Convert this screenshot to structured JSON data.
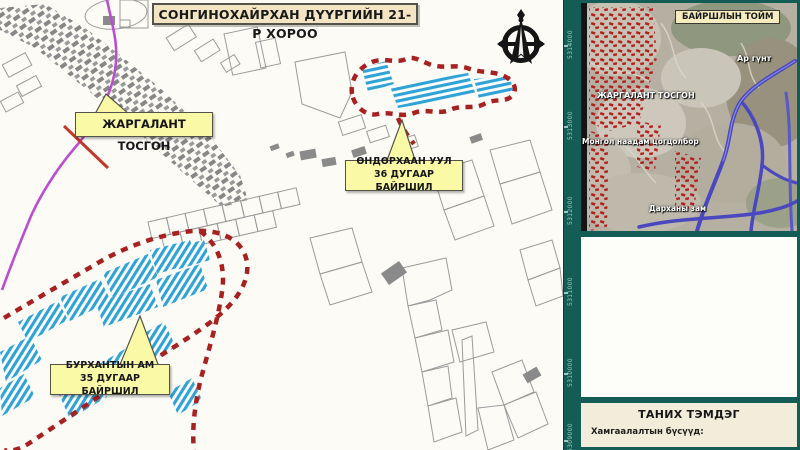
{
  "map": {
    "title": "СОНГИНОХАЙРХАН ДҮҮРГИЙН 21-Р ХОРОО",
    "callouts": {
      "jargalant": {
        "label": "ЖАРГАЛАНТ ТОСГОН"
      },
      "undurkhaan": {
        "line1": "ӨНДӨРХААН УУЛ",
        "line2": "36 ДУГААР БАЙРШИЛ"
      },
      "burkhantyn": {
        "line1": "БУРХАНТЫН АМ",
        "line2": "35 ДУГААР БАЙРШИЛ"
      }
    },
    "grid_labels": [
      "5314000",
      "5313000",
      "5312000",
      "5311000",
      "5310000",
      "5309000"
    ]
  },
  "inset": {
    "title": "БАЙРШЛЫН ТОЙМ",
    "labels": {
      "argunt": "Ар гүнт",
      "jargalant": "ЖАРГАЛАНТ ТОСГОН",
      "naadam": "Монгол наадам цогцолбор",
      "darkhan": "Дарханы зам"
    }
  },
  "legend": {
    "title": "ТАНИХ ТЭМДЭГ",
    "subtitle": "Хамгаалалтын бүсүүд:"
  },
  "colors": {
    "frame_teal": "#145d57",
    "title_bg": "#f3e5c3",
    "callout_yellow": "#fafaa6",
    "boundary_red": "#a82020",
    "parcel_hatch_blue": "#2fa3d6",
    "road_purple": "#b84fd0",
    "rail_red": "#c0392b",
    "inset_road_blue": "#4a47bf",
    "legend_bg": "#f2edda",
    "parcel_outline_gray": "#9b9b9b"
  }
}
